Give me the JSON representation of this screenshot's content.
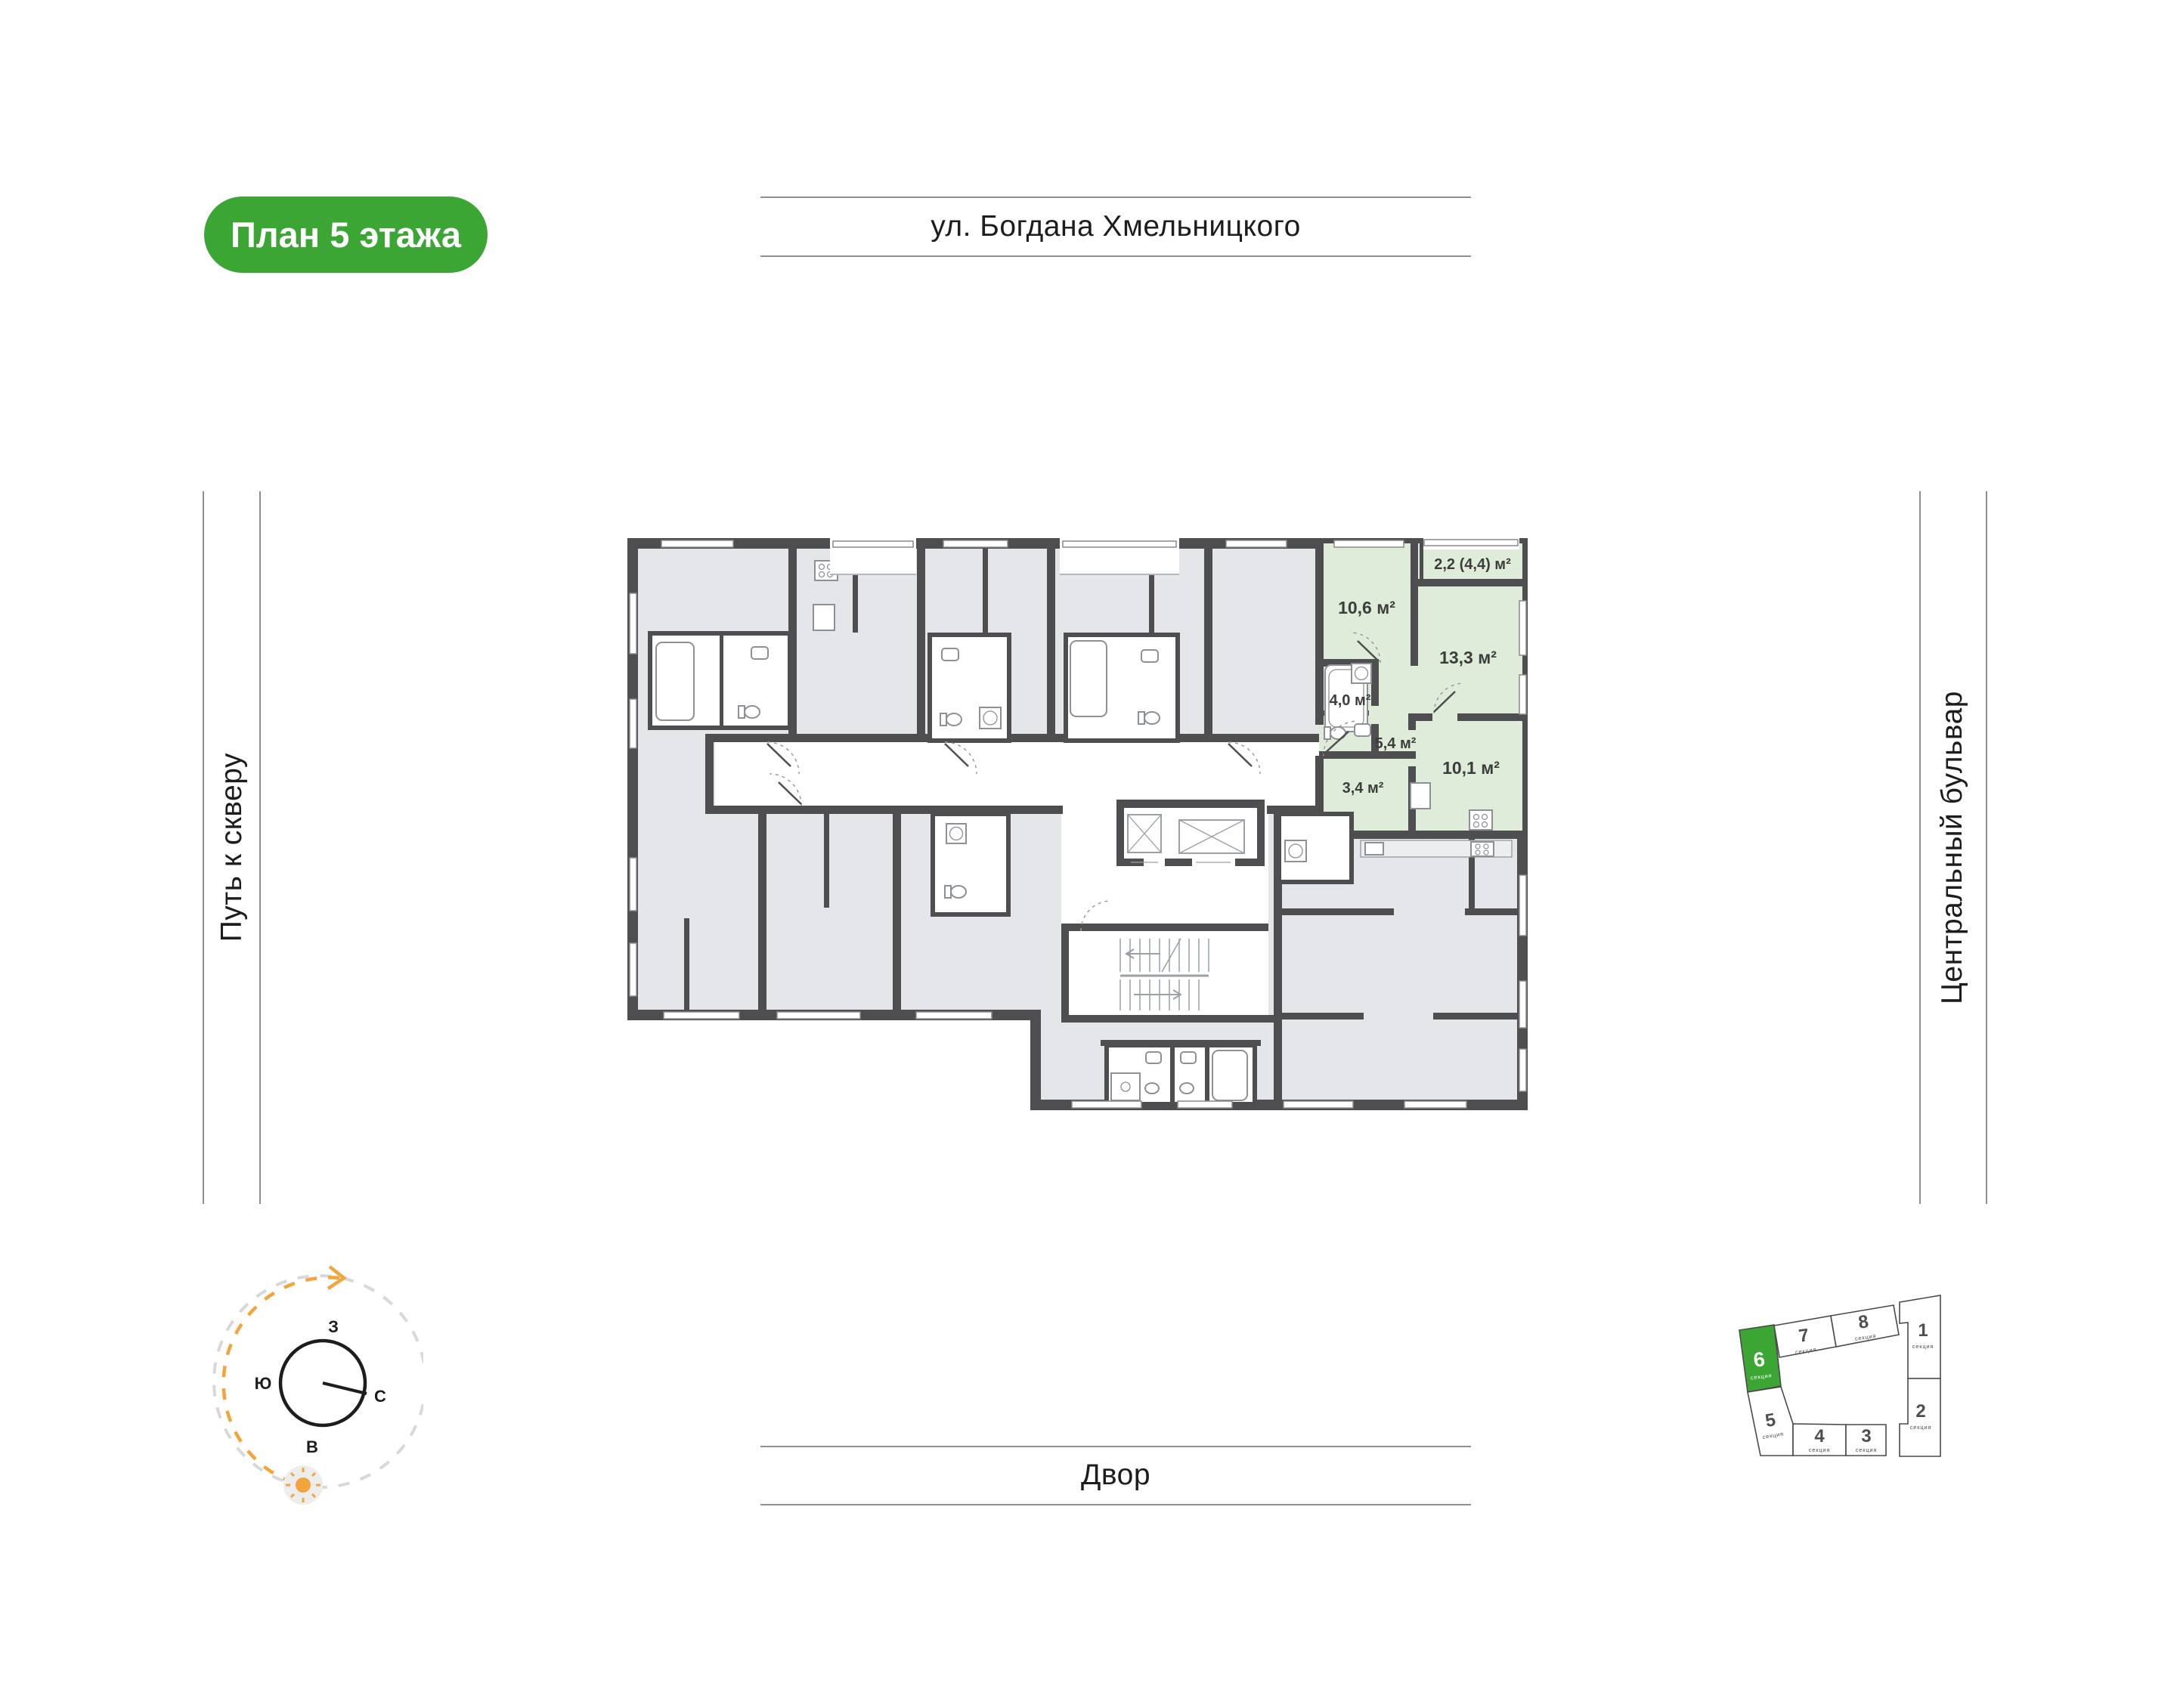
{
  "badge": {
    "label": "План 5 этажа",
    "bg": "#3ba634",
    "color": "#ffffff"
  },
  "streets": {
    "top": "ул. Богдана Хмельницкого",
    "left": "Путь к скверу",
    "right": "Центральный бульвар",
    "bottom": "Двор"
  },
  "plan": {
    "highlight_color": "#dfecd9",
    "wall_color": "#4e4e50",
    "room_fill": "#e4e6ea",
    "rooms": [
      {
        "name": "balcony",
        "area": "2,2 (4,4) м²"
      },
      {
        "name": "bedroom",
        "area": "10,6 м²"
      },
      {
        "name": "living-room",
        "area": "13,3 м²"
      },
      {
        "name": "bathroom",
        "area": "4,0 м²"
      },
      {
        "name": "hallway",
        "area": "5,4 м²"
      },
      {
        "name": "kitchen",
        "area": "10,1 м²"
      },
      {
        "name": "room",
        "area": "3,4 м²"
      }
    ]
  },
  "compass": {
    "west": "З",
    "south": "Ю",
    "north": "С",
    "east": "В"
  },
  "minimap": {
    "caption": "секция",
    "highlighted_section": "6",
    "accent_color": "#3ba634",
    "sections": [
      {
        "num": "6"
      },
      {
        "num": "7"
      },
      {
        "num": "8"
      },
      {
        "num": "1"
      },
      {
        "num": "2"
      },
      {
        "num": "5"
      },
      {
        "num": "4"
      },
      {
        "num": "3"
      }
    ]
  }
}
